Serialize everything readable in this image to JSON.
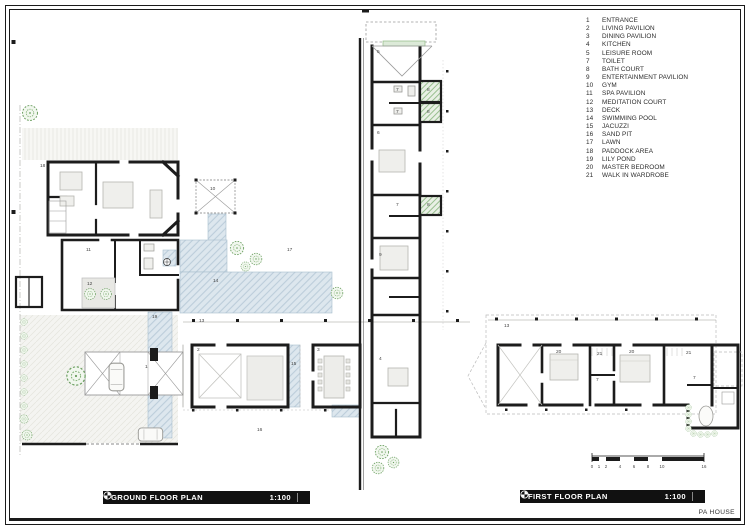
{
  "legend": {
    "items": [
      {
        "num": "1",
        "label": "ENTRANCE"
      },
      {
        "num": "2",
        "label": "LIVING PAVILION"
      },
      {
        "num": "3",
        "label": "DINING PAVILION"
      },
      {
        "num": "4",
        "label": "KITCHEN"
      },
      {
        "num": "5",
        "label": "LEISURE ROOM"
      },
      {
        "num": "7",
        "label": "TOILET"
      },
      {
        "num": "8",
        "label": "BATH COURT"
      },
      {
        "num": "9",
        "label": "ENTERTAINMENT PAVILION"
      },
      {
        "num": "10",
        "label": "GYM"
      },
      {
        "num": "11",
        "label": "SPA PAVILION"
      },
      {
        "num": "12",
        "label": "MEDITATION COURT"
      },
      {
        "num": "13",
        "label": "DECK"
      },
      {
        "num": "14",
        "label": "SWIMMING POOL"
      },
      {
        "num": "15",
        "label": "JACUZZI"
      },
      {
        "num": "16",
        "label": "SAND PIT"
      },
      {
        "num": "17",
        "label": "LAWN"
      },
      {
        "num": "18",
        "label": "PADDOCK AREA"
      },
      {
        "num": "19",
        "label": "LILY POND"
      },
      {
        "num": "20",
        "label": "MASTER BEDROOM"
      },
      {
        "num": "21",
        "label": "WALK IN WARDROBE"
      }
    ]
  },
  "titles": {
    "ground": {
      "label": "GROUND FLOOR PLAN",
      "scale": "1:100"
    },
    "first": {
      "label": "FIRST FLOOR PLAN",
      "scale": "1:100"
    },
    "project": "PA HOUSE"
  },
  "scale_bar": {
    "ticks": [
      {
        "t": "0",
        "dx": 0
      },
      {
        "t": "1",
        "dx": 7
      },
      {
        "t": "2",
        "dx": 14
      },
      {
        "t": "4",
        "dx": 28
      },
      {
        "t": "6",
        "dx": 42
      },
      {
        "t": "8",
        "dx": 56
      },
      {
        "t": "10",
        "dx": 70
      },
      {
        "t": "16",
        "dx": 112
      }
    ]
  },
  "plan_labels": [
    {
      "n": "18",
      "x": 40,
      "y": 167
    },
    {
      "n": "5",
      "x": 377,
      "y": 53
    },
    {
      "n": "7",
      "x": 396,
      "y": 91
    },
    {
      "n": "8",
      "x": 427,
      "y": 91
    },
    {
      "n": "7",
      "x": 396,
      "y": 113
    },
    {
      "n": "8",
      "x": 427,
      "y": 113
    },
    {
      "n": "6",
      "x": 377,
      "y": 134
    },
    {
      "n": "7",
      "x": 396,
      "y": 206
    },
    {
      "n": "8",
      "x": 427,
      "y": 206
    },
    {
      "n": "9",
      "x": 379,
      "y": 256
    },
    {
      "n": "10",
      "x": 210,
      "y": 190
    },
    {
      "n": "11",
      "x": 86,
      "y": 251
    },
    {
      "n": "12",
      "x": 87,
      "y": 285
    },
    {
      "n": "17",
      "x": 287,
      "y": 251
    },
    {
      "n": "14",
      "x": 213,
      "y": 282
    },
    {
      "n": "19",
      "x": 152,
      "y": 318
    },
    {
      "n": "13",
      "x": 199,
      "y": 322
    },
    {
      "n": "1",
      "x": 145,
      "y": 368
    },
    {
      "n": "2",
      "x": 197,
      "y": 351
    },
    {
      "n": "15",
      "x": 291,
      "y": 365
    },
    {
      "n": "3",
      "x": 317,
      "y": 351
    },
    {
      "n": "4",
      "x": 379,
      "y": 360
    },
    {
      "n": "16",
      "x": 257,
      "y": 431
    },
    {
      "n": "13",
      "x": 504,
      "y": 327
    },
    {
      "n": "20",
      "x": 556,
      "y": 353
    },
    {
      "n": "21",
      "x": 597,
      "y": 355
    },
    {
      "n": "7",
      "x": 596,
      "y": 381
    },
    {
      "n": "20",
      "x": 629,
      "y": 353
    },
    {
      "n": "21",
      "x": 686,
      "y": 354
    },
    {
      "n": "7",
      "x": 693,
      "y": 379
    }
  ],
  "colors": {
    "wall": "#1c1c1c",
    "water": "#ccdae4",
    "tree": "#6b9f60",
    "ground_hatch": "#e2e2dc",
    "bar_bg": "#111111"
  }
}
